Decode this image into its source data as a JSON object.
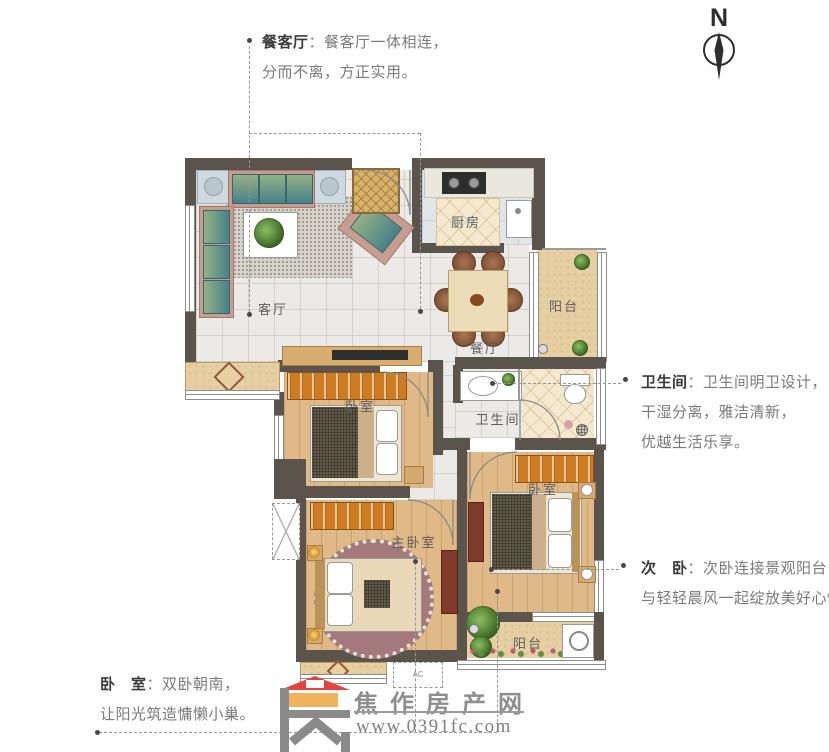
{
  "compass": {
    "label": "N"
  },
  "rooms": {
    "living": "客厅",
    "dining": "餐厅",
    "kitchen": "厨房",
    "balcony_top": "阳台",
    "bathroom": "卫生间",
    "bedroom1": "卧室",
    "bedroom2": "卧室",
    "master": "主卧室",
    "balcony_bottom": "阳台",
    "ac": "AC"
  },
  "annotations": {
    "dining_living": {
      "label": "餐客厅",
      "sep": "：",
      "line1": "餐客厅一体相连，",
      "line2": "分而不离，方正实用。"
    },
    "bathroom": {
      "label": "卫生间",
      "sep": "：",
      "line1": "卫生间明卫设计，",
      "line2": "干湿分离，雅洁清新，",
      "line3": "优越生活乐享。"
    },
    "second_bedroom": {
      "label": "次　卧",
      "sep": "：",
      "line1": "次卧连接景观阳台，",
      "line2": "与轻轻晨风一起绽放美好心情。"
    },
    "bedrooms": {
      "label": "卧　室",
      "sep": "：",
      "line1": "双卧朝南，",
      "line2": "让阳光筑造慵懒小巢。"
    }
  },
  "watermark": {
    "site_name": "焦作房产网",
    "url": "www.0391fc.com"
  },
  "colors": {
    "wall": "#5b544c",
    "wood_floor": "#dfba85",
    "tile_floor": "#eceae6",
    "balcony_floor": "#e6cfa2",
    "wardrobe": "#cd7c22",
    "logo_red": "#e0463d",
    "logo_orange": "#f0b35c",
    "watermark_gray": "#8e8e8e",
    "leader": "#979797"
  }
}
